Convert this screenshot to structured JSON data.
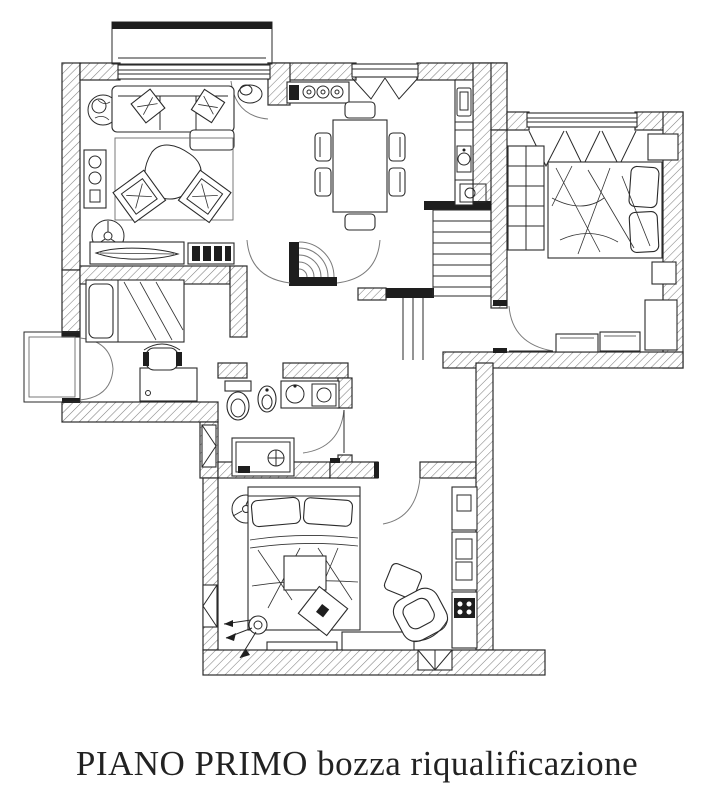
{
  "caption": {
    "text": "PIANO PRIMO bozza riqualificazione"
  },
  "drawing": {
    "type": "architectural-floor-plan",
    "style": "black ink on white paper, diagonal-hatched masonry walls",
    "floor_label": "PIANO PRIMO",
    "revision_label": "bozza riqualificazione",
    "balconies": [
      "top-balcony",
      "left-balcony"
    ],
    "rooms": [
      {
        "name": "living-room",
        "furniture": [
          "sofa-with-chaise",
          "throw-pillows",
          "area-rug",
          "organic-coffee-table",
          "accent-armchair",
          "accent-armchair",
          "potted-plant",
          "hifi-cabinet",
          "ceiling-fan",
          "low-console-with-decor",
          "tv-media-unit"
        ]
      },
      {
        "name": "dining-room",
        "furniture": [
          "dining-table",
          "chair",
          "chair",
          "chair",
          "chair",
          "chair",
          "chair",
          "appliance-counter-with-hob"
        ]
      },
      {
        "name": "kitchen-strip",
        "furniture": [
          "fridge",
          "sink",
          "base-counter",
          "oven-unit"
        ]
      },
      {
        "name": "bedroom-right",
        "furniture": [
          "double-bed",
          "pillows",
          "wardrobe-column",
          "nightstand",
          "nightstand",
          "tall-dresser",
          "low-dresser",
          "low-dresser"
        ],
        "openings": [
          "triple-casement-window",
          "door"
        ]
      },
      {
        "name": "bedroom-small-left",
        "furniture": [
          "single-bed",
          "desk",
          "desk-chair"
        ],
        "openings": [
          "french-doors-to-balcony"
        ]
      },
      {
        "name": "bathroom",
        "furniture": [
          "toilet",
          "bidet",
          "washbasin-cabinet",
          "washing-machine",
          "shower-enclosure"
        ],
        "openings": [
          "door",
          "window"
        ]
      },
      {
        "name": "bedroom-bottom",
        "furniture": [
          "double-bed",
          "pillows",
          "ceiling-fan",
          "wall-art-tilted",
          "tripod-floor-lamp",
          "low-cabinet",
          "bench",
          "ottoman",
          "lounge-armchair",
          "kitchenette-column",
          "cooktop"
        ],
        "openings": [
          "door",
          "window-left",
          "window-bottom"
        ]
      },
      {
        "name": "hall",
        "features": [
          "door-swing",
          "door-swing",
          "arched-masonry-niche"
        ]
      },
      {
        "name": "staircase",
        "features": [
          "upper-flight-8-treads",
          "lower-flight"
        ]
      }
    ]
  },
  "colors": {
    "ink": "#1e1e1e",
    "paper": "#ffffff",
    "hatch": "#808080"
  }
}
